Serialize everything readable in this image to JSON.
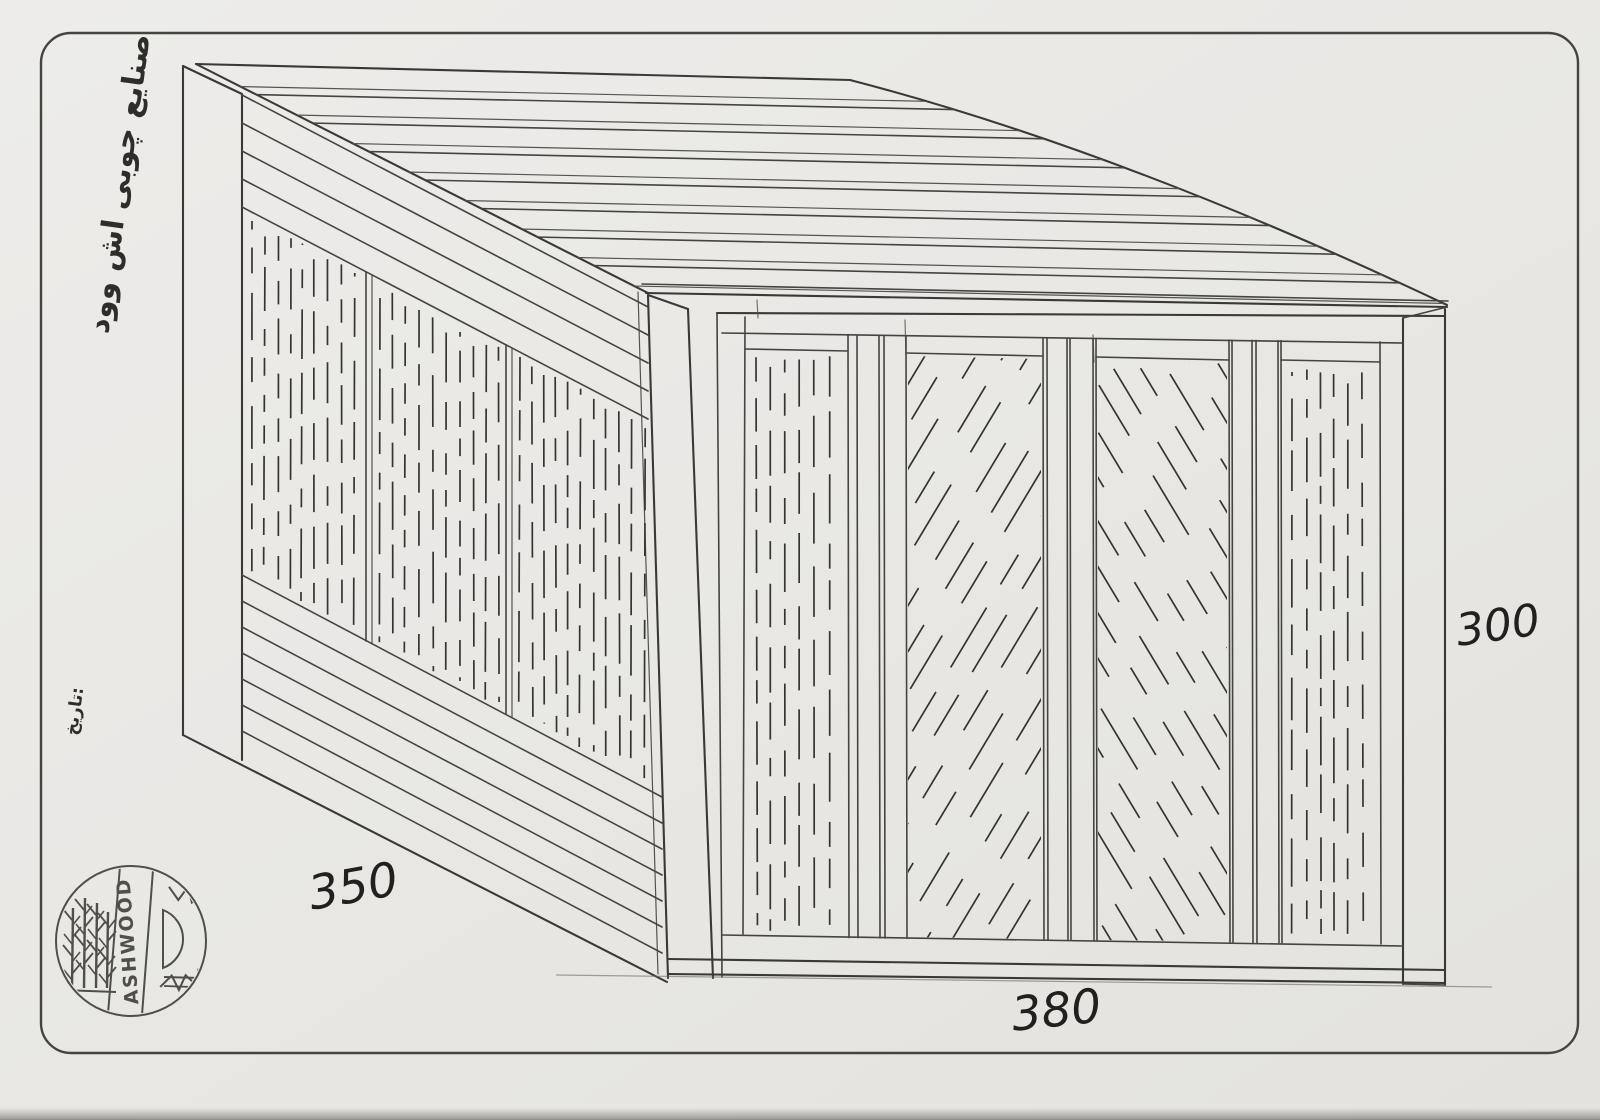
{
  "labels": {
    "company_fa": "صنایع چوبی اش وود",
    "date_fa": "تاریخ:",
    "dim_side": "350",
    "dim_front": "380",
    "dim_height": "300"
  },
  "logo": {
    "text": "ASHWOOD"
  },
  "colors": {
    "paper": "#e9e8e4",
    "border": "#45443f",
    "ink": "#3a3937",
    "grain": "#35342f",
    "handwriting": "#21201e"
  }
}
